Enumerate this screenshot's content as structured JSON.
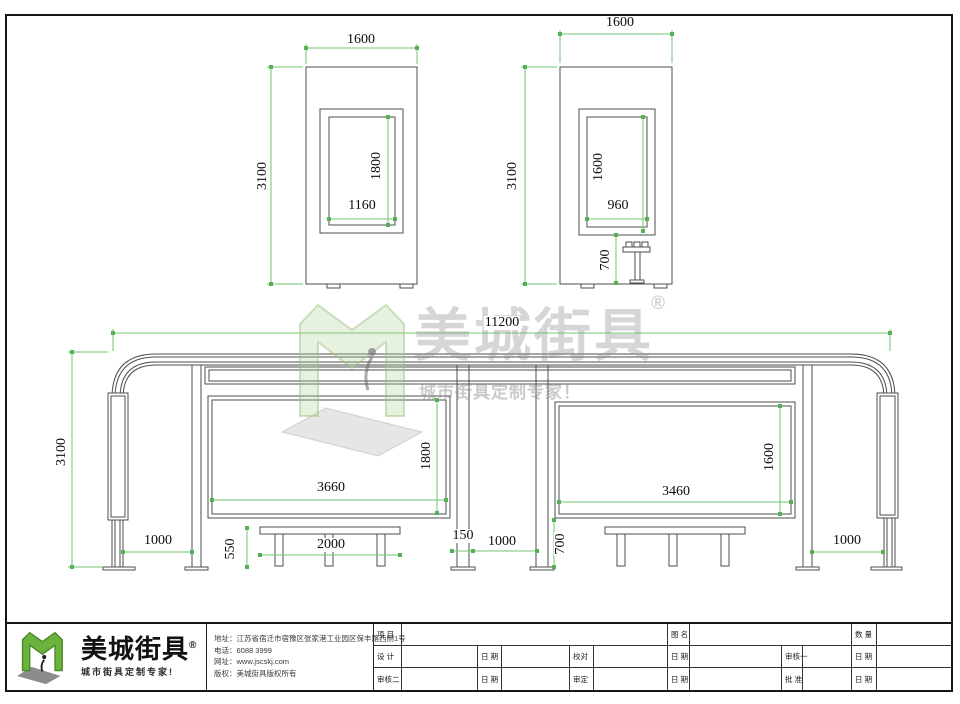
{
  "watermark": {
    "brand": "美城街具",
    "reg": "®",
    "tagline": "城市街具定制专家！"
  },
  "dims": {
    "side_left": {
      "width": "1600",
      "height": "3100",
      "panel_height": "1800",
      "panel_width": "1160"
    },
    "side_right": {
      "width": "1600",
      "height": "3100",
      "panel_height": "1600",
      "panel_width": "960",
      "seat_height": "700"
    },
    "front": {
      "total_width": "11200",
      "height": "3100",
      "left_bay": "1000",
      "bench_height": "550",
      "bench_width": "2000",
      "left_panel_width": "3660",
      "left_panel_height": "1800",
      "post_gap": "150",
      "center_gap": "1000",
      "panel_bottom": "700",
      "right_panel_width": "3460",
      "right_panel_height": "1600",
      "right_bay": "1000"
    }
  },
  "title_block": {
    "brand": "美城街具",
    "reg": "®",
    "tagline": "城市街具定制专家!",
    "info": {
      "line1": "地址：江苏省宿迁市宿豫区张家港工业园区保丰路西侧1号",
      "line2": "电话：6088 3999",
      "line3": "网址：www.jscskj.com",
      "line4": "版权：美城街具版权所有"
    },
    "table": {
      "r1c1": "项 目",
      "r1c2": "图 名",
      "r1c3": "数 量",
      "r2c1": "设 计",
      "r2c2": "日 期",
      "r2c3": "校对",
      "r2c4": "日 期",
      "r2c5": "审核一",
      "r2c6": "日 期",
      "r3c1": "审核二",
      "r3c2": "日 期",
      "r3c3": "审定",
      "r3c4": "日 期",
      "r3c5": "批 准",
      "r3c6": "日 期"
    }
  }
}
